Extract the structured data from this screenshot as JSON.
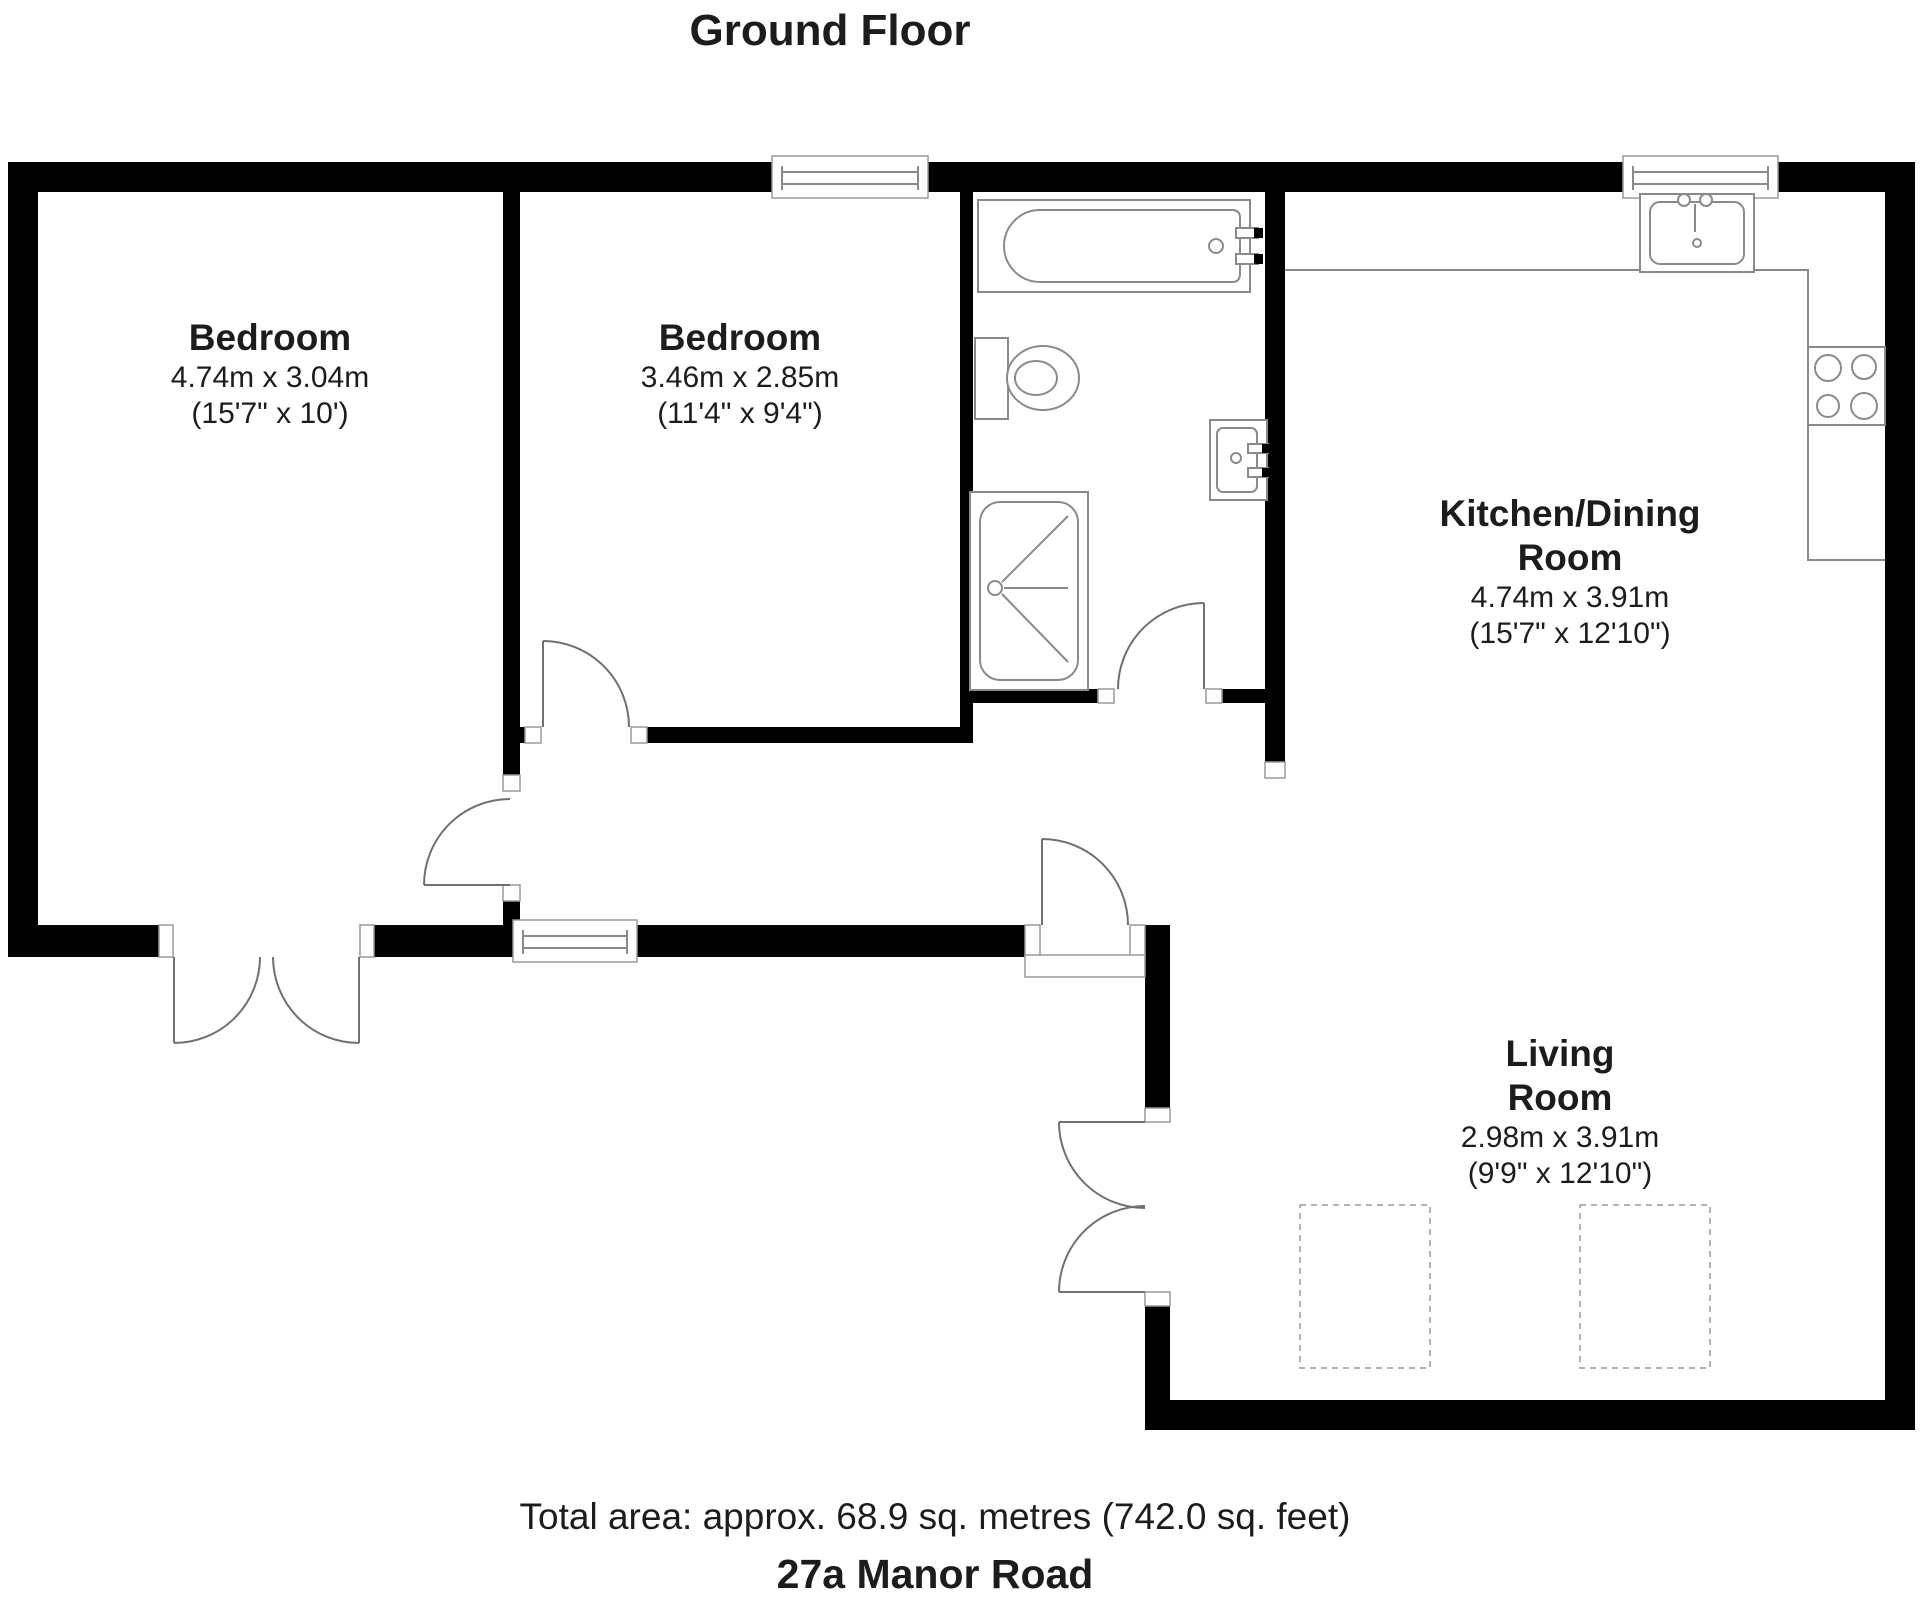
{
  "page_title": "Ground Floor",
  "rooms": {
    "bedroom1": {
      "name": "Bedroom",
      "metric": "4.74m x 3.04m",
      "imperial": "(15'7\" x 10')"
    },
    "bedroom2": {
      "name": "Bedroom",
      "metric": "3.46m x 2.85m",
      "imperial": "(11'4\" x 9'4\")"
    },
    "kitchen": {
      "name_line1": "Kitchen/Dining",
      "name_line2": "Room",
      "metric": "4.74m x 3.91m",
      "imperial": "(15'7\" x 12'10\")"
    },
    "living": {
      "name_line1": "Living",
      "name_line2": "Room",
      "metric": "2.98m x 3.91m",
      "imperial": "(9'9\" x 12'10\")"
    }
  },
  "footer": {
    "total_area": "Total area: approx. 68.9 sq. metres (742.0 sq. feet)",
    "address": "27a Manor Road"
  },
  "colors": {
    "wall": "#000000",
    "fixture_line": "#8a8a8a",
    "door_line": "#707070",
    "text": "#1c1c1c",
    "background": "#ffffff"
  }
}
